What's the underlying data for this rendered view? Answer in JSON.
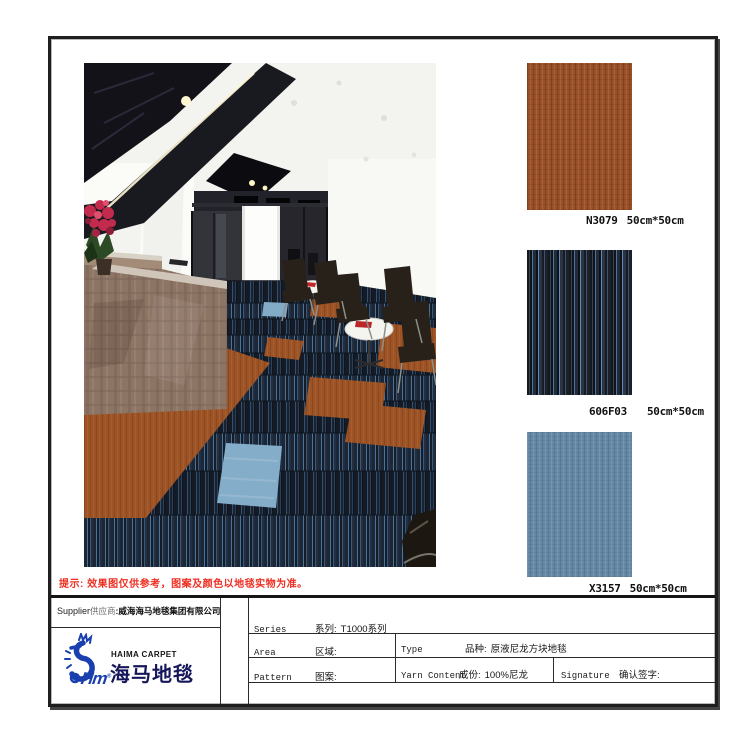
{
  "note": {
    "text": "提示: 效果图仅供参考，图案及颜色以地毯实物为准。",
    "color": "#ee2f23"
  },
  "photo": {
    "description": "office reception room floored with striped navy carpet tiles, rust orange tile path and light blue accent tiles"
  },
  "swatches": [
    {
      "code": "N3079",
      "size": "50cm*50cm",
      "color": "#9a5129"
    },
    {
      "code": "606F03",
      "size": "50cm*50cm",
      "color": "#161b23"
    },
    {
      "code": "X3157",
      "size": "50cm*50cm",
      "color": "#6589a7"
    }
  ],
  "supplier": {
    "en": "Supplier",
    "zh": "供应商",
    "value": ":威海海马地毯集团有限公司"
  },
  "logo": {
    "brand_en": "HAIMA CARPET",
    "brand_zh": "海马地毯",
    "monogram": "Hm",
    "reg": "®",
    "blue": "#1a3fae"
  },
  "spec_table": {
    "series": {
      "en": "Series",
      "zh": "系列:",
      "value": "T1000系列"
    },
    "area": {
      "en": "Area",
      "zh": "区域:",
      "value": ""
    },
    "pattern": {
      "en": "Pattern",
      "zh": "图案:",
      "value": ""
    },
    "type": {
      "en": "Type",
      "zh": "品种:",
      "value": "原液尼龙方块地毯"
    },
    "yarn": {
      "en": "Yarn Content",
      "zh": "成份:",
      "value": "100%尼龙"
    },
    "signature": {
      "en": "Signature",
      "zh": "确认签字:",
      "value": ""
    }
  }
}
